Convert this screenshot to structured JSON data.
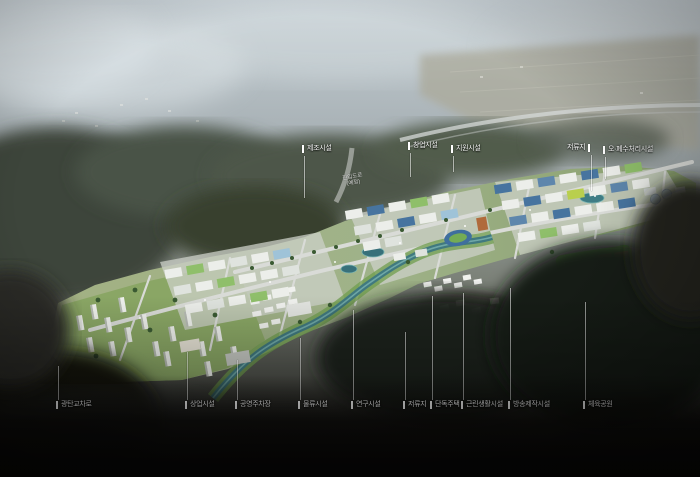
{
  "image": {
    "type": "aerial-masterplan-rendering"
  },
  "colors": {
    "label_text": "#ffffff",
    "leader_line": "rgba(255,255,255,0.55)",
    "site_lawn": "#7fb347",
    "river_teal": "#40797f",
    "roof_blue": "#47749f",
    "forest_dark": "#1f221b",
    "haze_sky": "#c6d0d6"
  },
  "callouts": {
    "top": [
      {
        "label": "제조시설"
      },
      {
        "label": "창업시설"
      },
      {
        "label": "지원시설"
      },
      {
        "label": "저류지"
      },
      {
        "label": "오·폐수처리시설"
      }
    ],
    "bottom": [
      {
        "label": "광탄교차로"
      },
      {
        "label": "상업시설"
      },
      {
        "label": "공영주차장"
      },
      {
        "label": "물류시설"
      },
      {
        "label": "연구시설"
      },
      {
        "label": "저류지"
      },
      {
        "label": "단독주택"
      },
      {
        "label": "근린생활시설"
      },
      {
        "label": "방송제작시설"
      },
      {
        "label": "체육공원"
      }
    ],
    "road": {
      "line1": "진입도로",
      "line2": "(예정)"
    }
  }
}
